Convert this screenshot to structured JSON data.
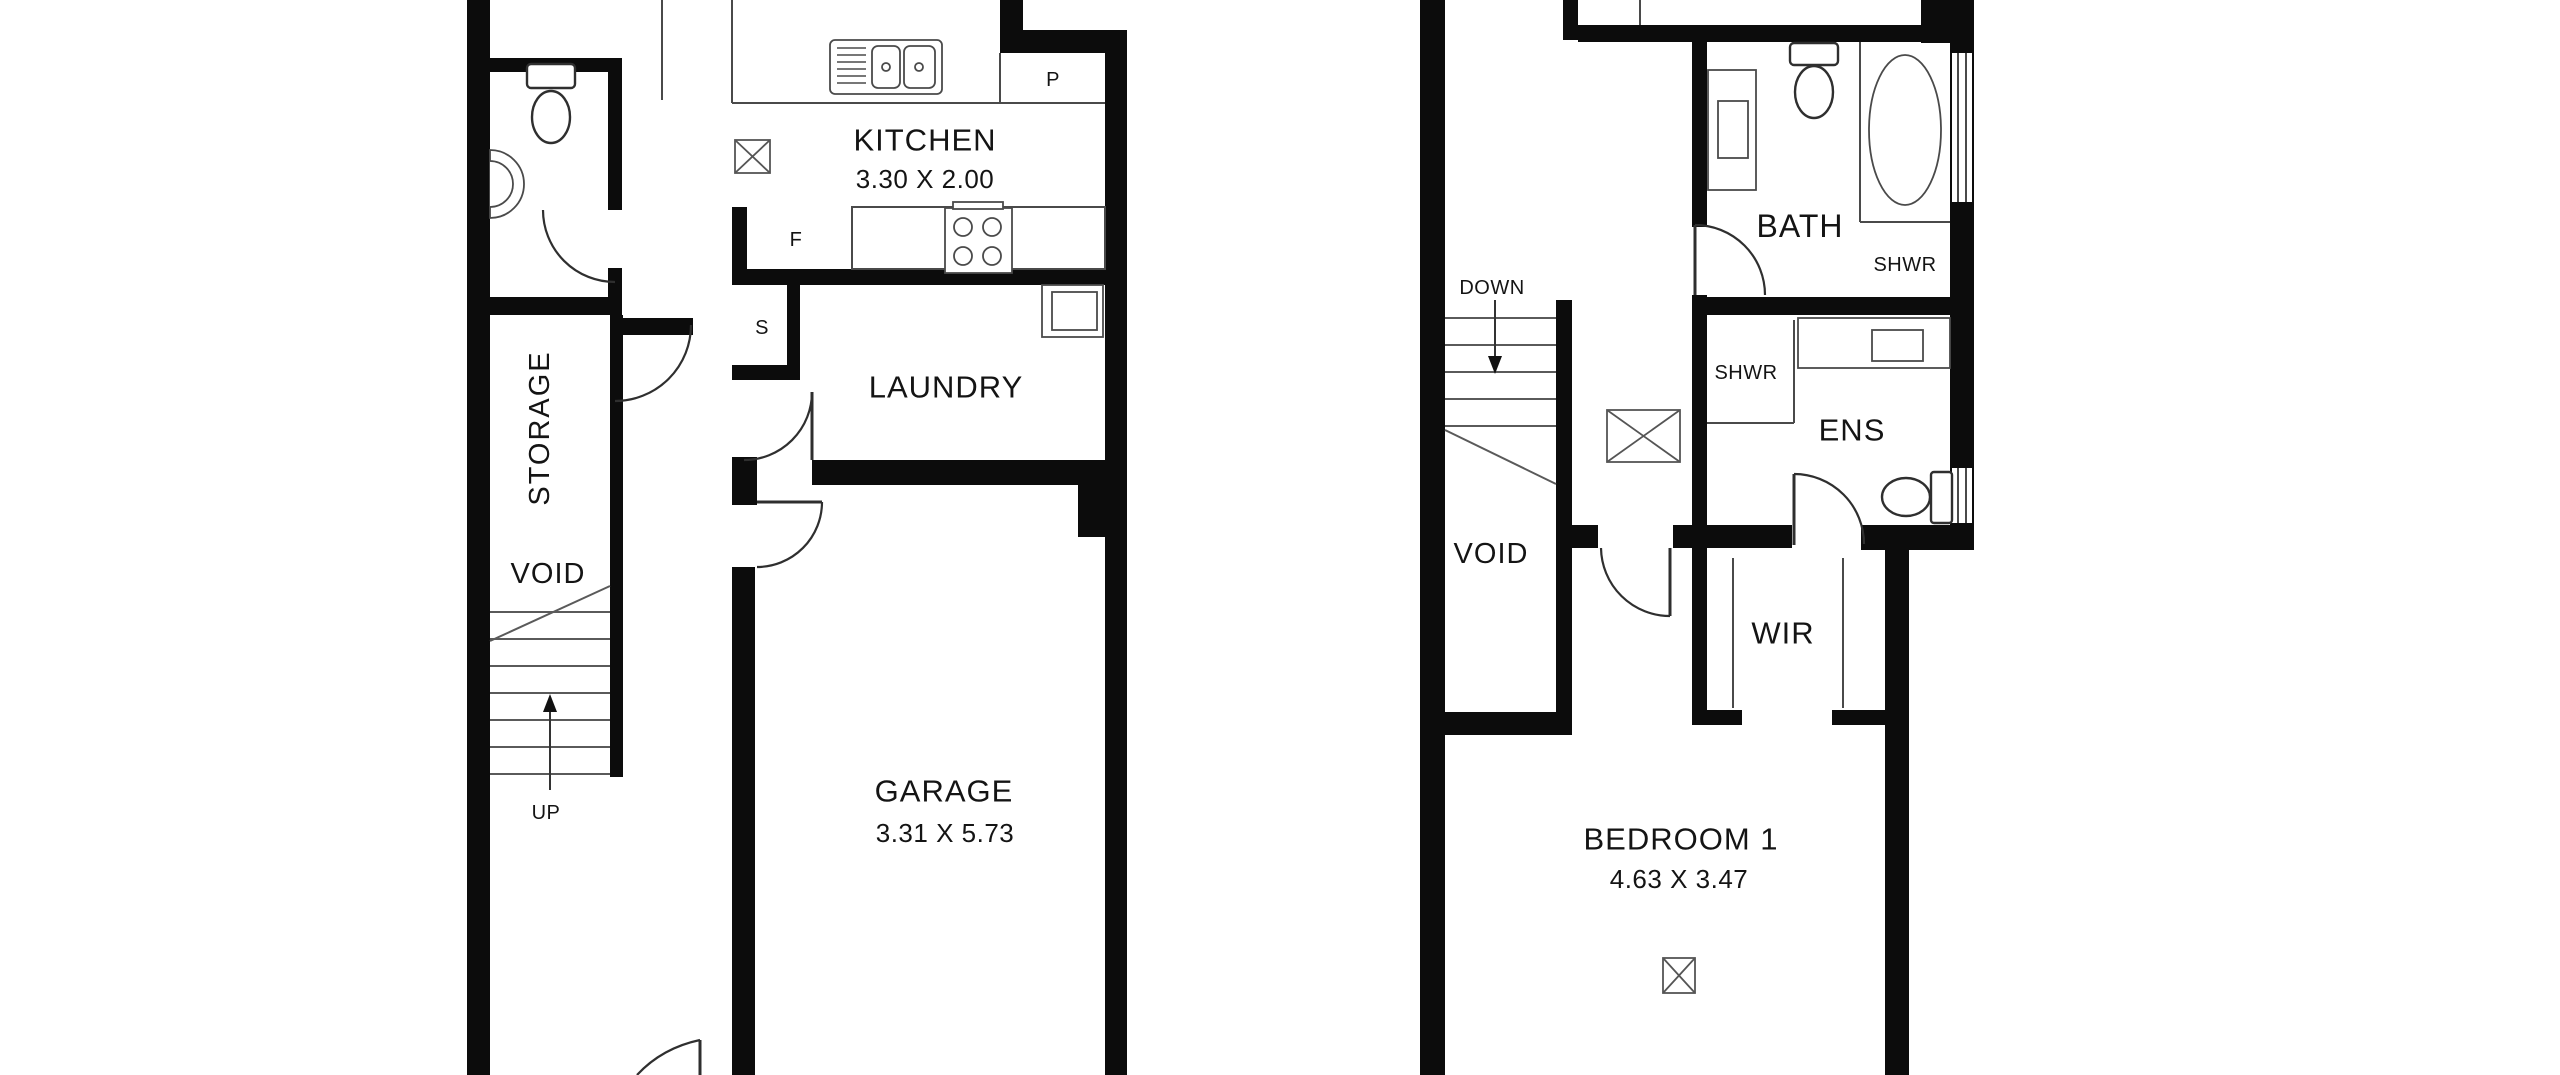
{
  "ground_floor": {
    "kitchen_label": "KITCHEN",
    "kitchen_dims": "3.30 X 2.00",
    "pantry_label": "P",
    "fridge_label": "F",
    "cupboard_label": "S",
    "laundry_label": "LAUNDRY",
    "storage_label": "STORAGE",
    "void_label": "VOID",
    "stairs_label": "UP",
    "garage_label": "GARAGE",
    "garage_dims": "3.31 X 5.73"
  },
  "upper_floor": {
    "stairs_label": "DOWN",
    "bath_label": "BATH",
    "bath_shower_label": "SHWR",
    "ens_shower_label": "SHWR",
    "ens_label": "ENS",
    "void_label": "VOID",
    "wir_label": "WIR",
    "bedroom_label": "BEDROOM 1",
    "bedroom_dims": "4.63 X 3.47"
  }
}
